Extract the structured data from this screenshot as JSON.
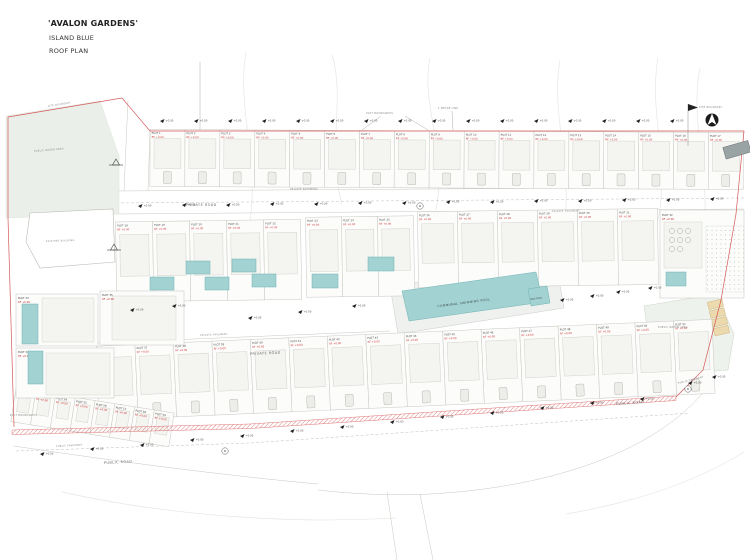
{
  "title_block": {
    "project": "'AVALON GARDENS'",
    "scheme": "ISLAND BLUE",
    "drawing": "ROOF PLAN"
  },
  "annotations": {
    "plot_boundaries": "PLOT BOUNDARIES",
    "plot_boundaries_2": "PLOT BOUNDARIES",
    "one_metre_line": "1 METRE LINE",
    "site_boundary": "SITE BOUNDARY",
    "site_boundary_2": "SITE BOUNDARY",
    "private_road_upper": "PRIVATE ROAD",
    "private_road_lower": "PRIVATE ROAD",
    "public_road_left": "PUBLIC ROAD",
    "public_road_right": "PUBLIC ROAD",
    "private_pavement_a": "PRIVATE PAVEMENT",
    "private_pavement_b": "PRIVATE PAVEMENT",
    "private_pavement_c": "PRIVATE PAVEMENT",
    "public_pavement_left": "PUBLIC PAVEMENT",
    "public_pavement_right": "PUBLIC PAVEMENT",
    "communal_pool": "COMMUNAL SWIMMING POOL",
    "kids_pool": "KIDS POOL",
    "green_area_left": "PUBLIC GREEN AREA",
    "green_area_right": "PUBLIC GREEN AREA",
    "existing_building": "EXISTING BUILDING",
    "spot_level": "+0.00",
    "roof_level": "RF +0.00"
  },
  "plots": {
    "top_row": [
      "PLOT 1",
      "PLOT 2",
      "PLOT 3",
      "PLOT 4",
      "PLOT 5",
      "PLOT 6",
      "PLOT 7",
      "PLOT 8",
      "PLOT 9",
      "PLOT 10",
      "PLOT 11",
      "PLOT 12",
      "PLOT 13",
      "PLOT 14",
      "PLOT 15",
      "PLOT 16",
      "PLOT 17"
    ],
    "mid_left": [
      "PLOT 18",
      "PLOT 19",
      "PLOT 20",
      "PLOT 21",
      "PLOT 22"
    ],
    "mid_center": [
      "PLOT 23",
      "PLOT 24",
      "PLOT 25"
    ],
    "mid_right": [
      "PLOT 26",
      "PLOT 27",
      "PLOT 28",
      "PLOT 29",
      "PLOT 30",
      "PLOT 31"
    ],
    "amenity": "PLOT 32",
    "villas": [
      "PLOT 33",
      "PLOT 34",
      "PLOT 35"
    ],
    "lower": [
      "PLOT 36",
      "PLOT 37",
      "PLOT 38",
      "PLOT 39",
      "PLOT 40",
      "PLOT 41",
      "PLOT 42",
      "PLOT 43",
      "PLOT 44",
      "PLOT 45",
      "PLOT 46",
      "PLOT 47",
      "PLOT 48",
      "PLOT 49",
      "PLOT 50",
      "PLOT 51"
    ],
    "bottom_left": [
      "PLOT 52",
      "PLOT 53",
      "PLOT 54",
      "PLOT 55",
      "PLOT 56",
      "PLOT 57",
      "PLOT 58",
      "PLOT 59"
    ]
  },
  "colors": {
    "boundary_red": "#d45858",
    "label_red": "#cc3333",
    "pool_teal": "#a3d2d2",
    "green_area": "#eaefe9",
    "parking_tan": "#ecd9ad"
  }
}
